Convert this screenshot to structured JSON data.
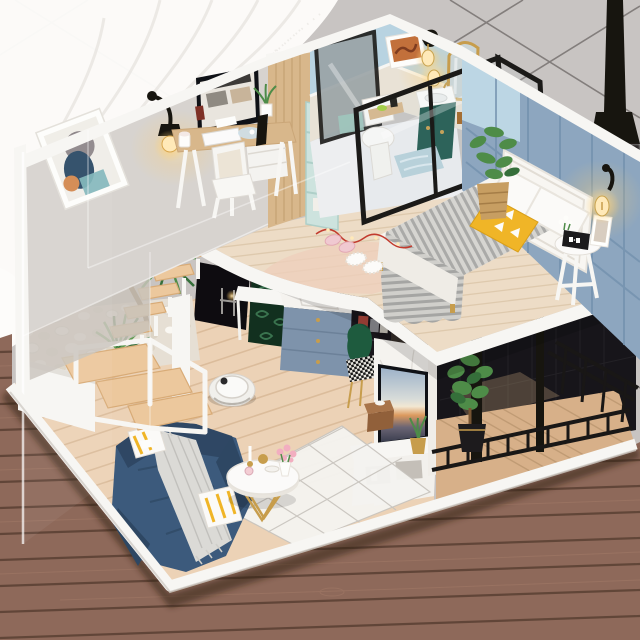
{
  "scene": {
    "type": "product-photo",
    "subject": "DIY miniature dollhouse loft apartment kit displayed on a wooden table against gray diamond-quilted wallpaper with a white lace curtain",
    "rooms": [
      {
        "name": "study-loft",
        "items": [
          "wooden desk",
          "computer monitor",
          "white keyboard",
          "white chair",
          "abstract wall art",
          "black wall sconce with warm bulb",
          "wood partition wall",
          "teal cube bookshelf"
        ]
      },
      {
        "name": "bathroom-loft",
        "items": [
          "dark teal vanity with white sink",
          "gold arch mirror",
          "white toilet",
          "orange art frame",
          "glowing sconce bulbs",
          "black framed glass partitions",
          "blue bath mat"
        ]
      },
      {
        "name": "bedroom-loft",
        "items": [
          "white headboard",
          "bed with gray striped blanket",
          "white pillows",
          "yellow triangle pillow",
          "white round bedside stool",
          "black alarm clock",
          "wall sconce with glowing bulb",
          "potted plant in woven basket",
          "slippers",
          "string lights"
        ]
      },
      {
        "name": "living-room",
        "items": [
          "navy blue sofa",
          "gray knit throw",
          "yellow striped pillows",
          "white round coffee table with gold legs",
          "pink flowers",
          "diamond pattern rug",
          "robot vacuum"
        ]
      },
      {
        "name": "kitchen-under-loft",
        "items": [
          "blue-gray drawer cabinet with gold knobs",
          "marble counter with sink",
          "open wardrobe with clothes",
          "green velvet chair with houndstooth seat",
          "leaf wallpaper nook",
          "white side table"
        ]
      },
      {
        "name": "tv-corner",
        "items": [
          "marble tv wall",
          "flat tv showing sunset",
          "white tv stand",
          "wooden tissue box",
          "gold pot plant"
        ]
      },
      {
        "name": "balcony",
        "items": [
          "black metal railing",
          "dark mesh screens",
          "potted green tree",
          "wood deck"
        ]
      },
      {
        "name": "garden-shaft",
        "items": [
          "white pebble planter",
          "floating wood stairs",
          "white stair railing frame",
          "palm plant with curved trunk",
          "yellow-green bush",
          "fern"
        ]
      }
    ],
    "background": [
      "gray quilted wallpaper with dark seams",
      "white lace curtain top-left",
      "black floor-lamp pole top-right",
      "reddish-brown plank table"
    ]
  },
  "colors": {
    "wallpaper": "#c8c4c2",
    "wallpaperSeam": "#4b4544",
    "curtain": "#fdfcfa",
    "curtainShade": "#e2dfda",
    "tableWood": "#8e695a",
    "tableSeam": "#5a4033",
    "tableGrain": "#a47c69",
    "platform": "#f0eeea",
    "platformSide": "#ddd9d3",
    "floorWood": "#ecd2b6",
    "floorSeam": "#d7b795",
    "loftWood": "#eddcc6",
    "loftSeam": "#d9c3a5",
    "balconyWood": "#d7b089",
    "balconySeam": "#bb9670",
    "wallLeft": "#d7d3cf",
    "wallLeftDim": "#c9c3bb",
    "trim": "#f7f6f3",
    "partitionWood": "#d8b78b",
    "partitionGrain": "#c19c6e",
    "shelfTeal": "#cde3de",
    "bathBlue": "#b8d3e1",
    "bathBeige": "#e9e2d6",
    "wallBlue": "#8da6bf",
    "wallBlueLine": "#7290ad",
    "wallBlueLight": "#bcd6e4",
    "vanityTeal": "#1e574c",
    "gold": "#c79d4c",
    "ink": "#17150f",
    "glassFrame": "#1b1a18",
    "headboard": "#f8f6f2",
    "duvet": "#f7f5f0",
    "bedSide": "#efece6",
    "blanket": "#d6d5d1",
    "blanketStripe": "#aaaaa8",
    "pillowWhite": "#fbfaf8",
    "pillowYellow": "#f0b527",
    "sofa": "#3c5a7c",
    "sofaDark": "#2e4763",
    "throw": "#dbdad6",
    "throwLine": "#bfbeba",
    "rug": "#f4f3ef",
    "rugLine": "#c7c3bd",
    "robot": "#f1f0ec",
    "robotRing": "#d5d1ca",
    "cabinetBlue": "#7e93ab",
    "wardrobeDark": "#19161b",
    "clothesRed": "#ab463c",
    "chairGreen": "#1e5b3e",
    "marble": "#f5f3ef",
    "marbleVein": "#dad6d0",
    "tvFrame": "#0f1116",
    "tissue": "#91603a",
    "tissueTop": "#a8744a",
    "railing": "#191716",
    "mesh": "#17151a",
    "plantGreen": "#4e8c48",
    "plantDark": "#356f3a",
    "plantYellow": "#adbf45",
    "fern": "#5f9a50",
    "trunk": "#795634",
    "stone": "#faf8f3",
    "stoneShade": "#dcd4c6",
    "basket": "#c79e62",
    "basketLine": "#a57d47",
    "leafWall": "#12301f",
    "leafVein": "#3f7c55",
    "pinkSlipper": "#f0c9d1",
    "peachRug": "#eecfbb",
    "mat": "#b8d2db",
    "soap": "#a3ce3c",
    "amber": "#a26420",
    "clock": "#1c1b1d",
    "mirrorGlass": "#ccd6d7",
    "stairWood": "#ecc89d",
    "stairEdge": "#d8ab77",
    "glowA": "#ffe9b8",
    "glowB": "#ffd073",
    "cordRed": "#c23b2e"
  }
}
